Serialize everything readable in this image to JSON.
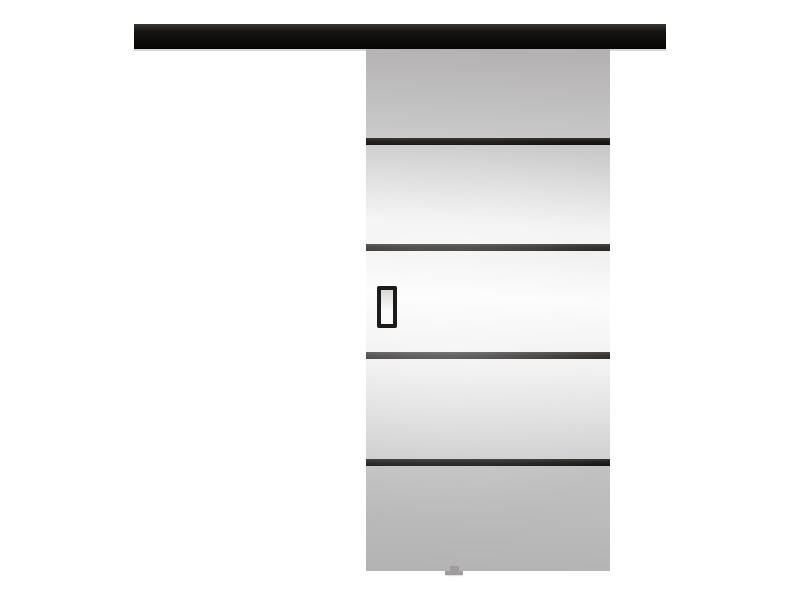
{
  "theme": {
    "page_bg": "#ffffff",
    "rail_top": "#3a3734",
    "rail_mid": "#171412",
    "rail_bottom": "#070605",
    "rail_edge": "#d9d9d9",
    "stripe": "#1f1c1a",
    "panel1_from": "#b2b0b1",
    "panel1_to": "#cbcaca",
    "panel2_from": "#c7c6c6",
    "panel2_to": "#f3f3f3",
    "panel3_from": "#ededed",
    "panel3_mid": "#fbfbfb",
    "panel3_to": "#efefef",
    "panel4_from": "#f3f3f3",
    "panel4_to": "#cccbcb",
    "panel5_from": "#c2c1c1",
    "panel5_to": "#b4b3b3",
    "handle": "#1d1a18",
    "handle_inner_from": "#d8d8d8",
    "handle_inner_to": "#fafafa",
    "guide": "#9e9c9c"
  },
  "structure": {
    "door_section_count": 5,
    "stripe_count": 4
  }
}
